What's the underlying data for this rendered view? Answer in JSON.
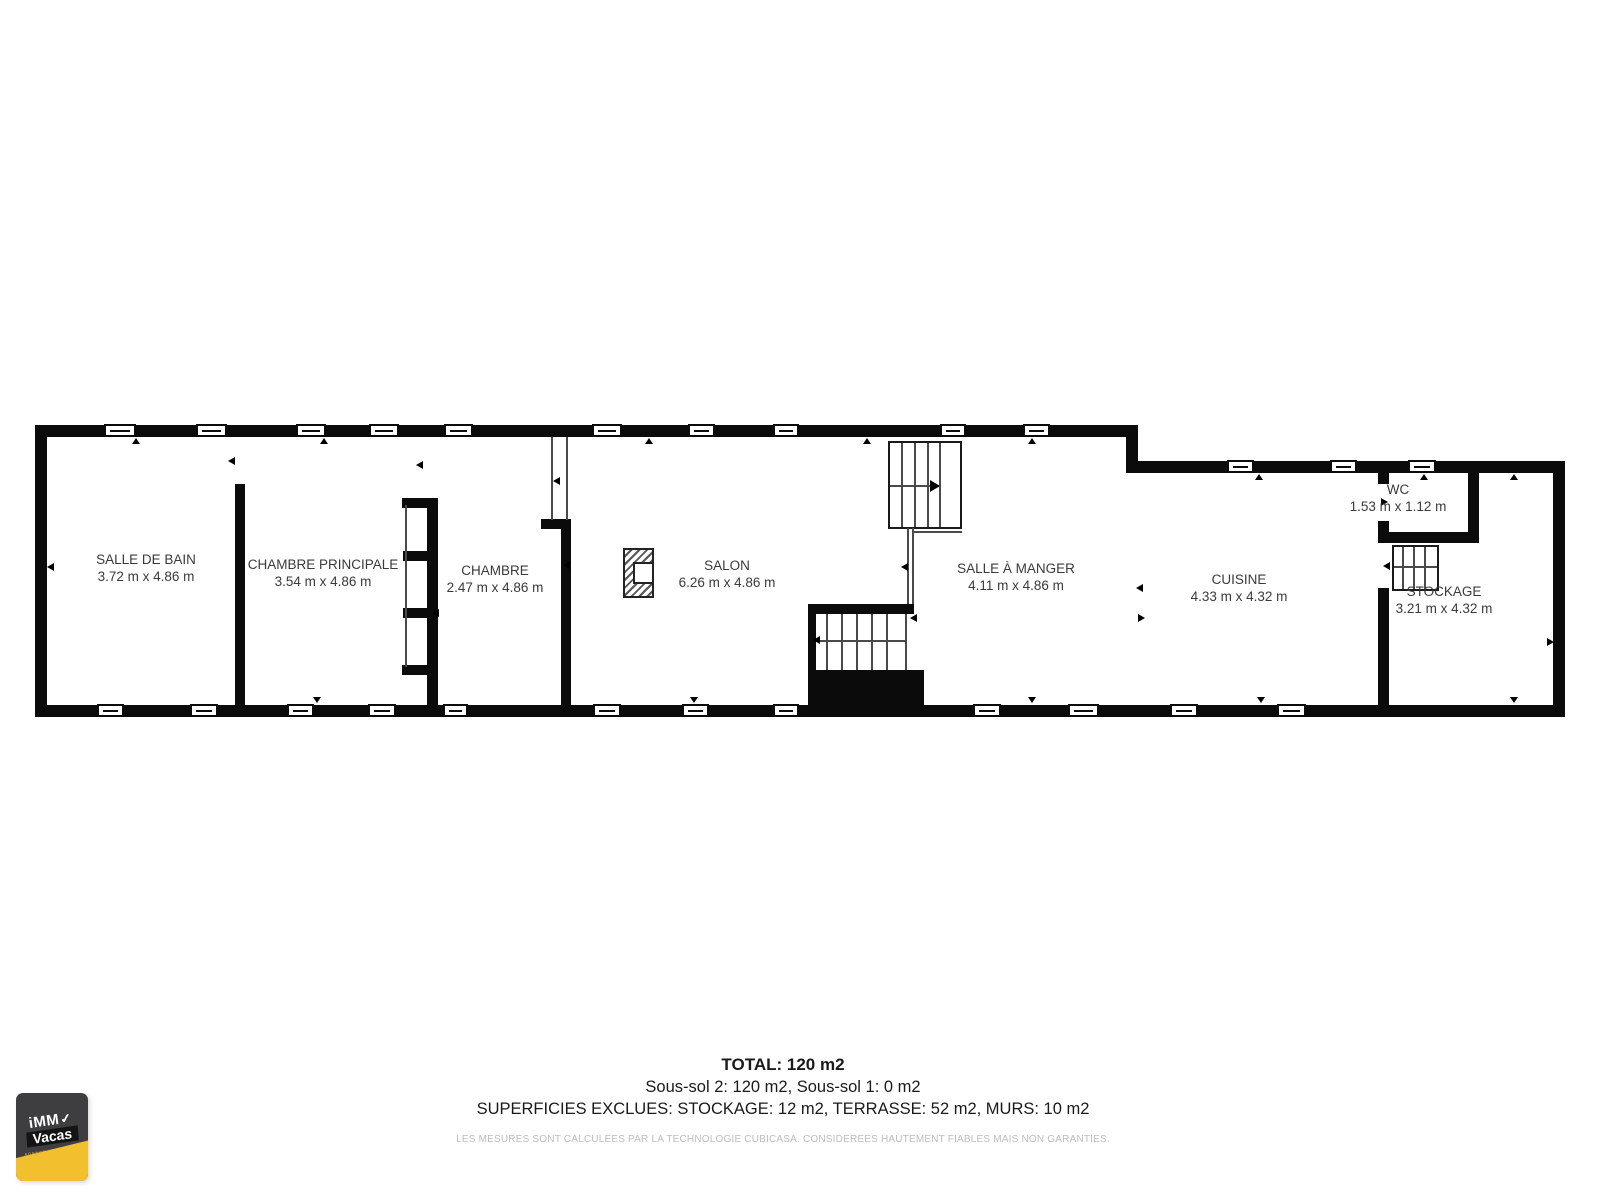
{
  "plan": {
    "rooms": [
      {
        "name": "SALLE DE BAIN",
        "dims": "3.72 m x 4.86 m"
      },
      {
        "name": "CHAMBRE PRINCIPALE",
        "dims": "3.54 m x 4.86 m"
      },
      {
        "name": "CHAMBRE",
        "dims": "2.47 m x 4.86 m"
      },
      {
        "name": "SALON",
        "dims": "6.26 m x 4.86 m"
      },
      {
        "name": "SALLE À MANGER",
        "dims": "4.11 m x 4.86 m"
      },
      {
        "name": "CUISINE",
        "dims": "4.33 m x 4.32 m"
      },
      {
        "name": "WC",
        "dims": "1.53 m x 1.12 m"
      },
      {
        "name": "STOCKAGE",
        "dims": "3.21 m x 4.32 m"
      }
    ]
  },
  "summary": {
    "total": "TOTAL: 120 m2",
    "levels": "Sous-sol 2: 120 m2, Sous-sol 1: 0 m2",
    "excluded": "SUPERFICIES EXCLUES: STOCKAGE: 12 m2, TERRASSE: 52 m2, MURS: 10 m2",
    "disclaimer": "LES MESURES SONT CALCULEES PAR LA TECHNOLOGIE CUBICASA. CONSIDEREES HAUTEMENT FIABLES MAIS NON GARANTIES."
  },
  "logo": {
    "brand_top": "iMM",
    "check": "✓",
    "brand_bottom": "Vacas",
    "tagline": "AGENCE IMMOBILIERE"
  },
  "colors": {
    "wall": "#0b0b0b",
    "label_text": "#3a3a3a",
    "disclaimer_text": "#bcbcbc",
    "logo_yellow": "#f2c02e",
    "logo_dark": "#3e3e40",
    "logo_band": "#141414"
  }
}
